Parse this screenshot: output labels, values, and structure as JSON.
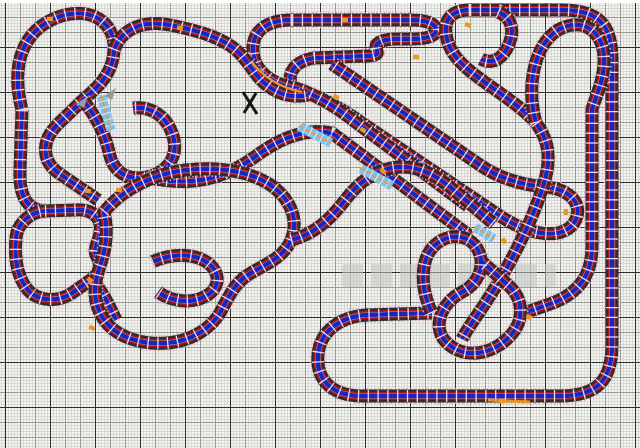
{
  "meta": {
    "description": "Slot car racing track layout plan drawn on graph paper",
    "canvas_kind": "track-design-drawing"
  },
  "colors": {
    "paper": "#f4f4f1",
    "grid_fine": "#d8d8d4",
    "grid_medium": "#9a9a96",
    "grid_heavy": "#2e2e2c",
    "track_casing": "#2b2b2b",
    "lane_red": "#b01212",
    "lane_blue": "#1626c4",
    "lane_separator": "#f0f0ee",
    "tie_white": "#ffffff",
    "selection_halo_pink": "#f2a6c8",
    "marker_yellow": "#e8991e",
    "chicane_blue": "#7fc2ee",
    "chicane_orange": "#f09a30",
    "arrow_gray": "#9b9b98",
    "start_cross_black": "#141414",
    "watermark_gray": "#c6c6c3"
  },
  "watermark": {
    "visible": true,
    "legible": false
  }
}
